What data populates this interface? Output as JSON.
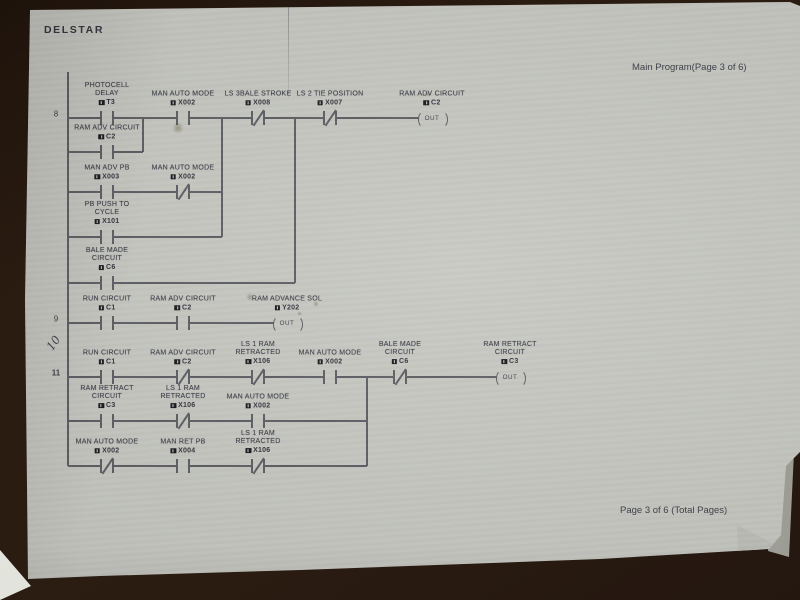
{
  "document": {
    "brand": "DELSTAR",
    "header_right": "Main Program(Page 3 of 6)",
    "footer_right": "Page 3 of 6 (Total Pages)",
    "handwritten_note": "10"
  },
  "colors": {
    "surface": "#281a10",
    "paper": "#c7c8c2",
    "ink": "#3e4049",
    "wire": "#5c5e63",
    "marker": "#17171c"
  },
  "ladder": {
    "rung_numbers": [
      {
        "label": "8",
        "x": 56,
        "y": 114,
        "bold": false
      },
      {
        "label": "9",
        "x": 56,
        "y": 319,
        "bold": false
      },
      {
        "label": "11",
        "x": 56,
        "y": 373,
        "bold": true
      }
    ],
    "wires": [
      {
        "x1": 68,
        "y1": 72,
        "x2": 68,
        "y2": 466
      },
      {
        "x1": 68,
        "y1": 118,
        "x2": 432,
        "y2": 118
      },
      {
        "x1": 68,
        "y1": 152,
        "x2": 143,
        "y2": 152
      },
      {
        "x1": 143,
        "y1": 118,
        "x2": 143,
        "y2": 152
      },
      {
        "x1": 68,
        "y1": 192,
        "x2": 222,
        "y2": 192
      },
      {
        "x1": 222,
        "y1": 118,
        "x2": 222,
        "y2": 237
      },
      {
        "x1": 68,
        "y1": 237,
        "x2": 222,
        "y2": 237
      },
      {
        "x1": 68,
        "y1": 283,
        "x2": 295,
        "y2": 283
      },
      {
        "x1": 295,
        "y1": 118,
        "x2": 295,
        "y2": 283
      },
      {
        "x1": 68,
        "y1": 323,
        "x2": 287,
        "y2": 323
      },
      {
        "x1": 68,
        "y1": 377,
        "x2": 510,
        "y2": 377
      },
      {
        "x1": 68,
        "y1": 421,
        "x2": 367,
        "y2": 421
      },
      {
        "x1": 68,
        "y1": 466,
        "x2": 367,
        "y2": 466
      },
      {
        "x1": 367,
        "y1": 377,
        "x2": 367,
        "y2": 466
      }
    ],
    "contacts": [
      {
        "x": 107,
        "y": 118,
        "type": "no",
        "name": [
          "PHOTOCELL",
          "DELAY"
        ],
        "tag": "T3"
      },
      {
        "x": 183,
        "y": 118,
        "type": "no",
        "name": [
          "MAN AUTO MODE"
        ],
        "tag": "X002"
      },
      {
        "x": 258,
        "y": 118,
        "type": "nc",
        "name": [
          "LS 3BALE STROKE"
        ],
        "tag": "X008"
      },
      {
        "x": 330,
        "y": 118,
        "type": "nc",
        "name": [
          "LS 2 TIE POSITION"
        ],
        "tag": "X007"
      },
      {
        "x": 107,
        "y": 152,
        "type": "no",
        "name": [
          "RAM ADV CIRCUIT"
        ],
        "tag": "C2"
      },
      {
        "x": 107,
        "y": 192,
        "type": "no",
        "name": [
          "MAN ADV PB"
        ],
        "tag": "X003"
      },
      {
        "x": 183,
        "y": 192,
        "type": "nc",
        "name": [
          "MAN AUTO MODE"
        ],
        "tag": "X002"
      },
      {
        "x": 107,
        "y": 237,
        "type": "no",
        "name": [
          "PB PUSH TO",
          "CYCLE"
        ],
        "tag": "X101"
      },
      {
        "x": 107,
        "y": 283,
        "type": "no",
        "name": [
          "BALE MADE",
          "CIRCUIT"
        ],
        "tag": "C6"
      },
      {
        "x": 107,
        "y": 323,
        "type": "no",
        "name": [
          "RUN CIRCUIT"
        ],
        "tag": "C1"
      },
      {
        "x": 183,
        "y": 323,
        "type": "no",
        "name": [
          "RAM ADV CIRCUIT"
        ],
        "tag": "C2"
      },
      {
        "x": 107,
        "y": 377,
        "type": "no",
        "name": [
          "RUN CIRCUIT"
        ],
        "tag": "C1"
      },
      {
        "x": 183,
        "y": 377,
        "type": "nc",
        "name": [
          "RAM ADV CIRCUIT"
        ],
        "tag": "C2"
      },
      {
        "x": 258,
        "y": 377,
        "type": "nc",
        "name": [
          "LS 1 RAM",
          "RETRACTED"
        ],
        "tag": "X106"
      },
      {
        "x": 330,
        "y": 377,
        "type": "no",
        "name": [
          "MAN AUTO MODE"
        ],
        "tag": "X002"
      },
      {
        "x": 400,
        "y": 377,
        "type": "nc",
        "name": [
          "BALE MADE",
          "CIRCUIT"
        ],
        "tag": "C6"
      },
      {
        "x": 107,
        "y": 421,
        "type": "no",
        "name": [
          "RAM RETRACT",
          "CIRCUIT"
        ],
        "tag": "C3"
      },
      {
        "x": 183,
        "y": 421,
        "type": "nc",
        "name": [
          "LS 1 RAM",
          "RETRACTED"
        ],
        "tag": "X106"
      },
      {
        "x": 258,
        "y": 421,
        "type": "no",
        "name": [
          "MAN AUTO MODE"
        ],
        "tag": "X002"
      },
      {
        "x": 107,
        "y": 466,
        "type": "nc",
        "name": [
          "MAN AUTO MODE"
        ],
        "tag": "X002"
      },
      {
        "x": 183,
        "y": 466,
        "type": "no",
        "name": [
          "MAN RET PB"
        ],
        "tag": "X004"
      },
      {
        "x": 258,
        "y": 466,
        "type": "nc",
        "name": [
          "LS 1 RAM",
          "RETRACTED"
        ],
        "tag": "X106"
      }
    ],
    "coils": [
      {
        "x": 432,
        "y": 118,
        "name": [
          "RAM ADV CIRCUIT"
        ],
        "tag": "C2",
        "inner": "OUT"
      },
      {
        "x": 287,
        "y": 323,
        "name": [
          "RAM ADVANCE SOL"
        ],
        "tag": "Y202",
        "inner": "OUT"
      },
      {
        "x": 510,
        "y": 377,
        "name": [
          "RAM RETRACT",
          "CIRCUIT"
        ],
        "tag": "C3",
        "inner": "OUT"
      }
    ],
    "stains": [
      {
        "x": 250,
        "y": 297,
        "r": 4
      },
      {
        "x": 316,
        "y": 304,
        "r": 3
      },
      {
        "x": 299,
        "y": 313,
        "r": 2.5
      },
      {
        "x": 428,
        "y": 94,
        "r": 3
      },
      {
        "x": 178,
        "y": 128,
        "r": 6
      }
    ]
  }
}
